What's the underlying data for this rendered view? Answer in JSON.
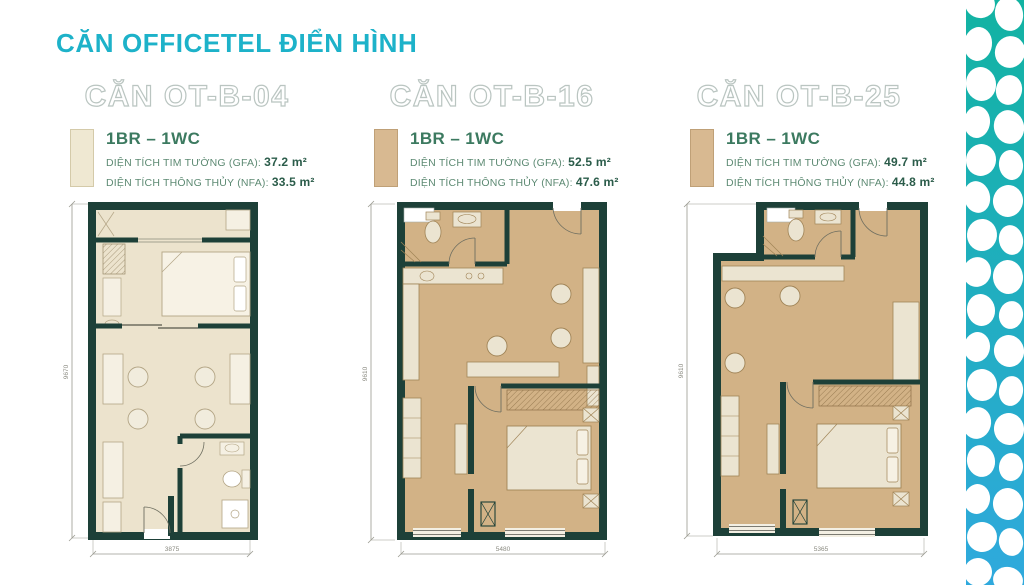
{
  "header": {
    "title": "CĂN OFFICETEL ĐIỂN HÌNH"
  },
  "area_labels": {
    "gfa": "DIỆN TÍCH TIM TƯỜNG (GFA):",
    "nfa": "DIỆN TÍCH THÔNG THỦY (NFA):"
  },
  "units": [
    {
      "title": "CĂN OT-B-04",
      "type": "1BR – 1WC",
      "gfa": "37.2 m²",
      "nfa": "33.5 m²",
      "plan_width_mm": "3875",
      "plan_height_mm": "9670"
    },
    {
      "title": "CĂN OT-B-16",
      "type": "1BR – 1WC",
      "gfa": "52.5 m²",
      "nfa": "47.6 m²",
      "plan_width_mm": "5480",
      "plan_height_mm": "9610"
    },
    {
      "title": "CĂN OT-B-25",
      "type": "1BR – 1WC",
      "gfa": "49.7 m²",
      "nfa": "44.8 m²",
      "plan_width_mm": "5365",
      "plan_height_mm": "9610"
    }
  ],
  "colors": {
    "accent": "#1db2c9",
    "wall": "#1d4038",
    "floor_light": "#ece3cd",
    "floor_tan": "#d2b286",
    "swatch_light": "#efe8d2",
    "swatch_tan": "#d8b991",
    "pattern_top": "#12b3a2",
    "pattern_bottom": "#2fa9dd"
  }
}
